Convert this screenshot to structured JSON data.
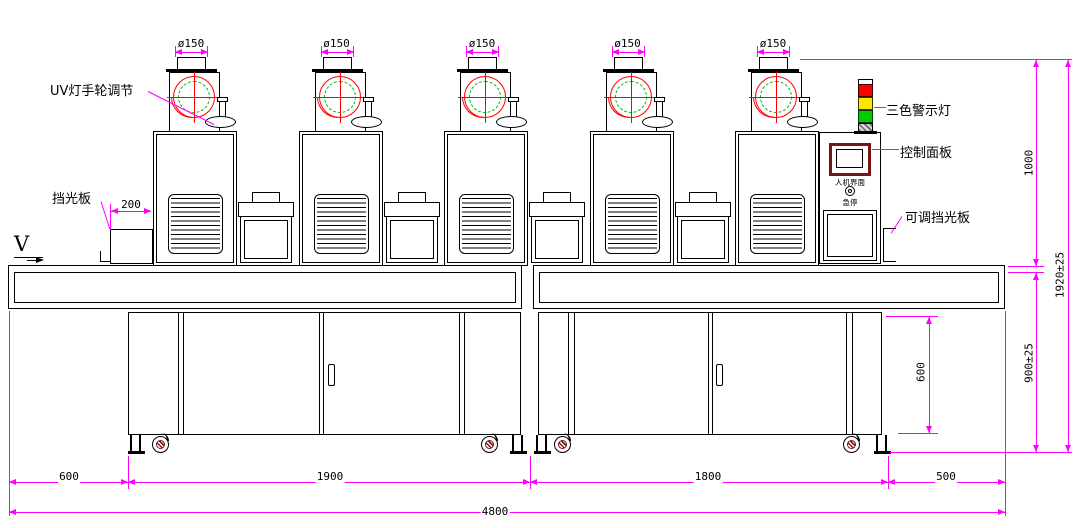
{
  "drawing": {
    "direction_label": "V",
    "annotations": {
      "uv_handwheel": "UV灯手轮调节",
      "shield": "挡光板",
      "tricolor_light": "三色警示灯",
      "control_panel": "控制面板",
      "adjustable_shield": "可调挡光板"
    },
    "control_panel": {
      "hmi_label": "人机界面",
      "estop_label": "急停"
    },
    "units": [
      {
        "duct_dim": "ø150"
      },
      {
        "duct_dim": "ø150"
      },
      {
        "duct_dim": "ø150"
      },
      {
        "duct_dim": "ø150"
      },
      {
        "duct_dim": "ø150"
      }
    ],
    "dims": {
      "shield_offset": "200",
      "lamp_section_height": "1000",
      "overall_height": "1920±25",
      "belt_height": "900±25",
      "base_cabinet_height": "600",
      "left_overhang": "600",
      "module_left_width": "1900",
      "module_right_width": "1800",
      "right_overhang": "500",
      "overall_length": "4800"
    },
    "colors": {
      "dimension": "#ff00ff",
      "outline": "#000000",
      "volute": "#ff0000",
      "lamp_circle": "#00b400",
      "panel_frame": "#7a1515",
      "light_red": "#ff0000",
      "light_yellow": "#ffe500",
      "light_green": "#00cc00"
    }
  }
}
